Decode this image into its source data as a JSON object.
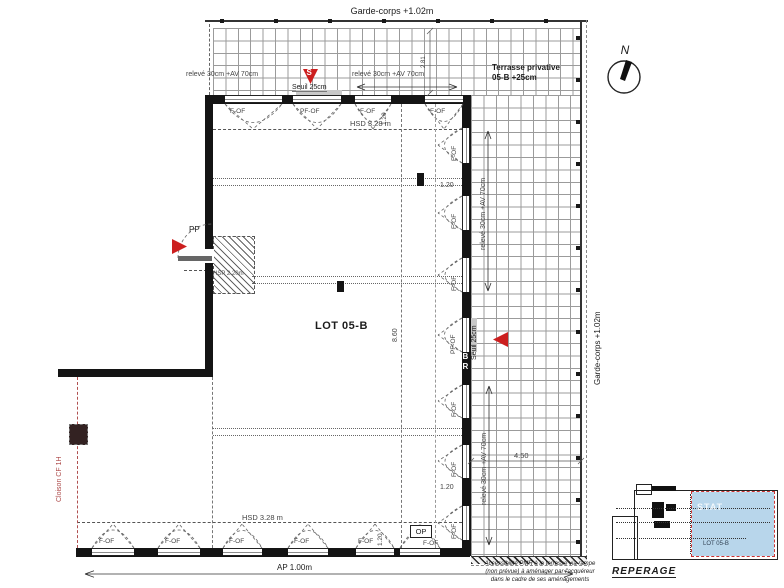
{
  "plan": {
    "garde_corps_top": "Garde-corps +1.02m",
    "garde_corps_right": "Garde-corps +1.02m",
    "terrasse_line1": "Terrasse privative",
    "terrasse_line2": "05-B +25cm",
    "lot": "LOT 05-B",
    "north": "N"
  },
  "windows": {
    "f_of": "F-OF",
    "pf_of": "PF-OF",
    "op": "OP"
  },
  "dims": {
    "releve": "relevé 30cm +AV 70cm",
    "seuil": "Seuil 25cm",
    "hsd": "HSD 3.28 m",
    "hsp": "HSP 2.20m",
    "d120": "1.20",
    "d281": "2.81",
    "d860": "8.60",
    "d450": "4.50",
    "ap": "AP 1.00m"
  },
  "annotations": {
    "pp": "PP",
    "cloison": "Cloison CF 1H",
    "s_marker": "S",
    "wall_letters": "BR",
    "note_line1": "Accessibilité PMR à la terrasse via rampe",
    "note_line2": "(non prévue) à aménager par l'acquéreur",
    "note_line3": "dans le cadre de ses aménagements"
  },
  "reperage": {
    "title": "REPERAGE",
    "lot": "LOT 05-B",
    "watermark": "STAT"
  },
  "colors": {
    "wall": "#141414",
    "terrace_grid": "#9b9b9b",
    "red_marker": "#cc1f1f",
    "partition_red": "#b05050",
    "lot_highlight": "#b8d6eb",
    "reperage_dash": "#cc3333"
  }
}
